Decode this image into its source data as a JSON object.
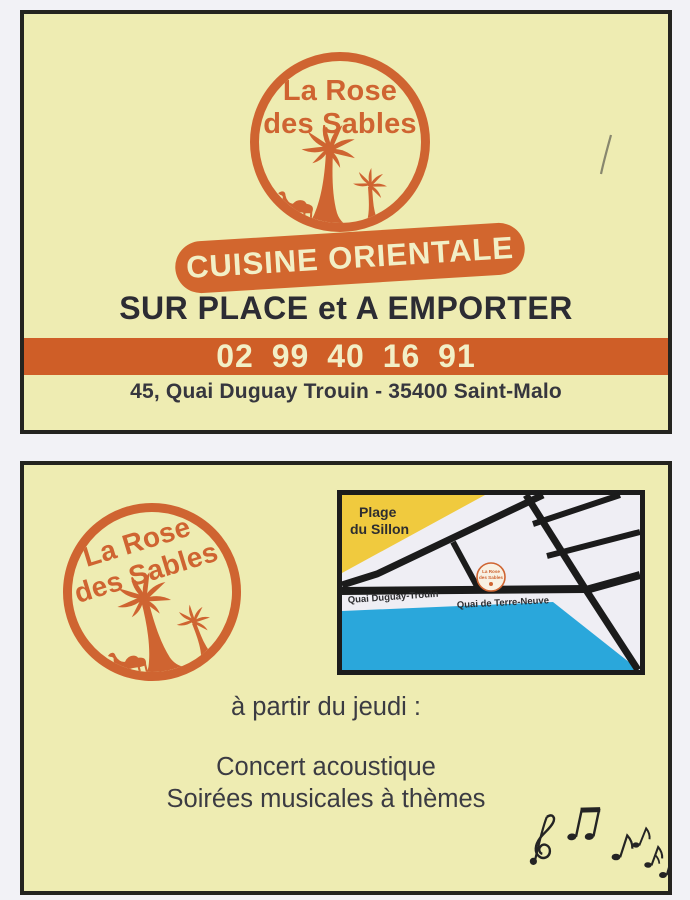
{
  "brand": {
    "line1": "La Rose",
    "line2": "des Sables",
    "tagline": "CUISINE ORIENTALE"
  },
  "front": {
    "service": "SUR PLACE et A EMPORTER",
    "phone": "02 99 40 16 91",
    "address": "45, Quai Duguay Trouin - 35400 Saint-Malo"
  },
  "back": {
    "map": {
      "beach1": "Plage",
      "beach2": "du Sillon",
      "quai1": "Quai Duguay-Trouin",
      "quai2": "Quai de Terre-Neuve",
      "marker1": "La Rose",
      "marker2": "des Sables"
    },
    "announcement": "à partir du jeudi :",
    "events": [
      "Concert acoustique",
      "Soirées musicales à thèmes"
    ]
  },
  "icons": {
    "logo": "palm-trees-camel-icon",
    "music": "music-notes-icon"
  },
  "colors": {
    "brand_orange": "#cf6431",
    "badge_orange": "#d2662e",
    "banner_orange": "#cf5e27",
    "cream": "#f2efc6",
    "card_background": "#eeecb2",
    "map_beach": "#f0ca3e",
    "map_water": "#2aa7db",
    "road_black": "#1b1b1b",
    "dark_text": "#2c2c33"
  }
}
